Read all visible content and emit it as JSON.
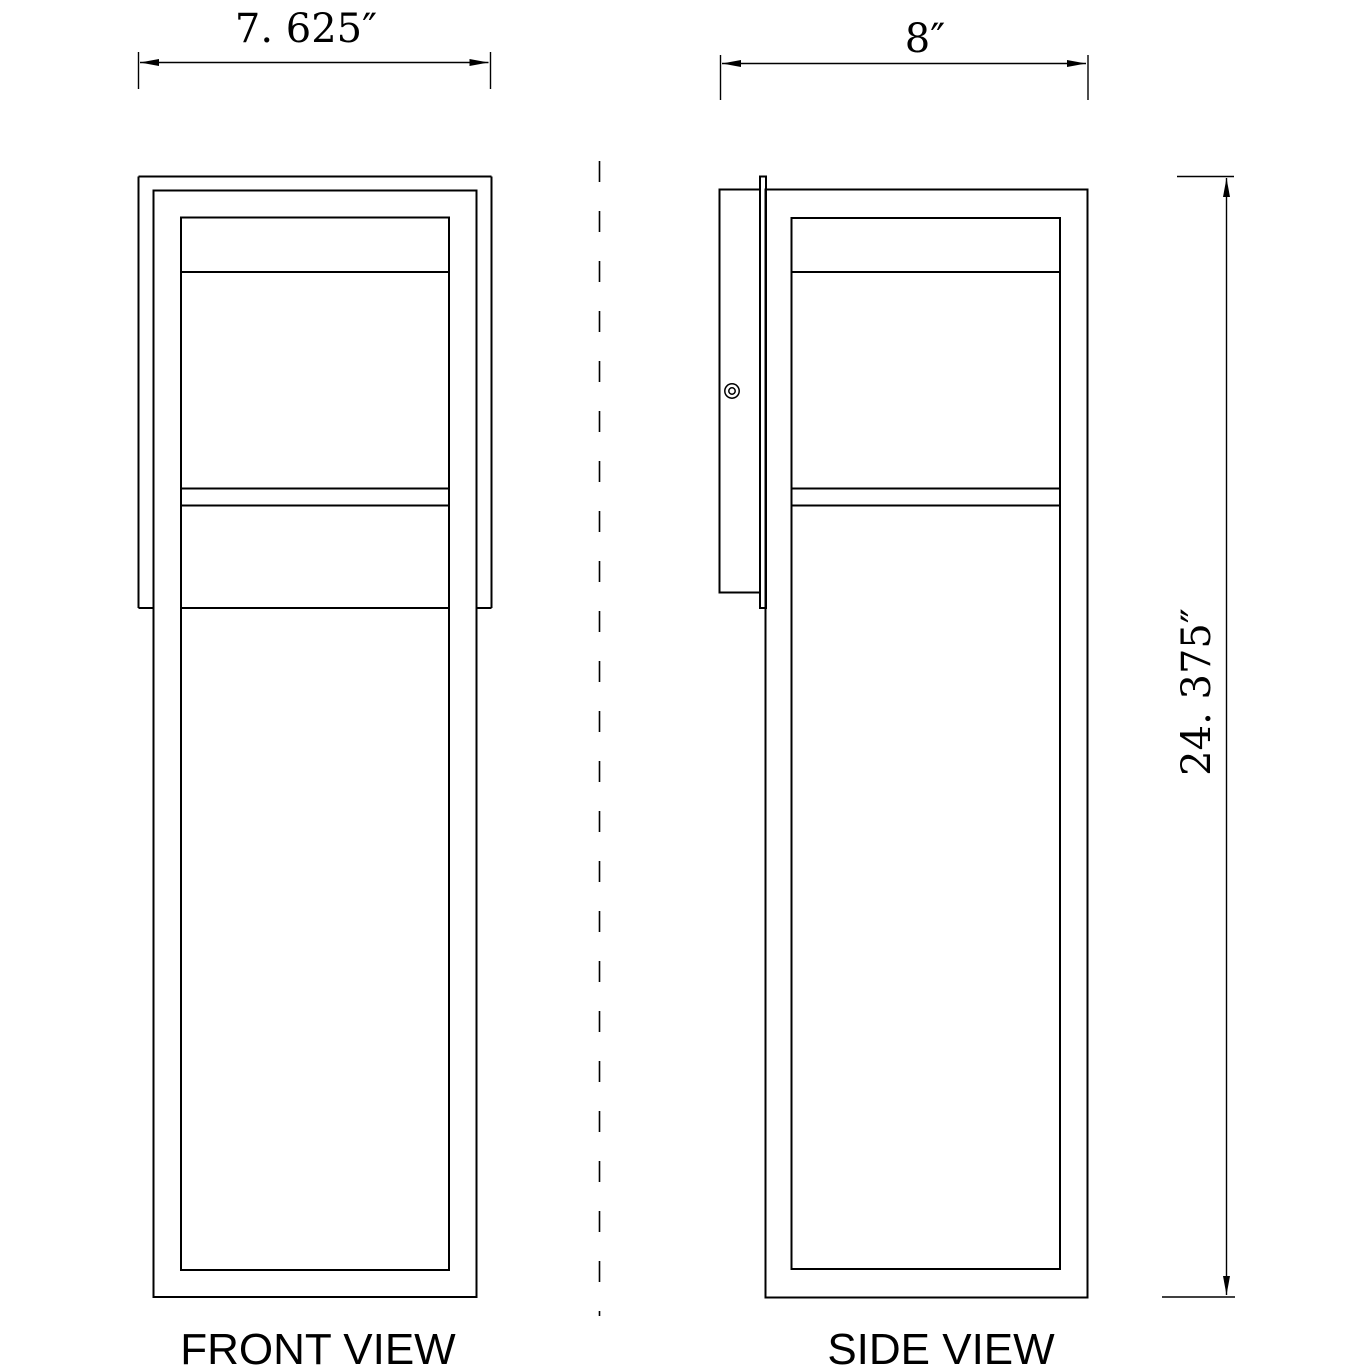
{
  "drawing": {
    "front_view": {
      "label": "FRONT VIEW",
      "width_dimension": "7. 625″"
    },
    "side_view": {
      "label": "SIDE VIEW",
      "width_dimension": "8″",
      "height_dimension": "24. 375″"
    },
    "colors": {
      "line": "#000000",
      "background": "#ffffff"
    }
  }
}
